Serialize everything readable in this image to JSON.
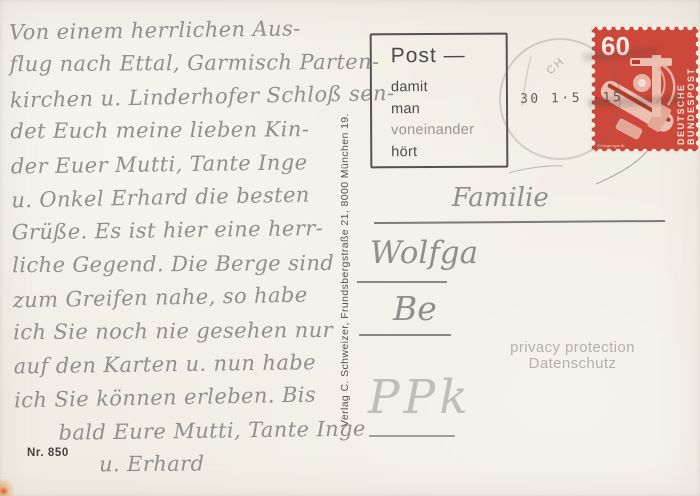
{
  "colors": {
    "paper": "#f1ede4",
    "stamp_red": "#cb483a",
    "pencil_gray": "#908f8b",
    "cancel_ink": "#4c4a46",
    "privacy_gray": "#b5b1a9"
  },
  "message": {
    "lines": [
      "Von einem herrlichen Aus-",
      "flug nach Ettal, Garmisch Parten-",
      "kirchen u. Linderhofer Schloß sen-",
      "det Euch meine lieben Kin-",
      "der Euer Mutti, Tante Inge",
      "u. Onkel Erhard die besten",
      "Grüße. Es ist hier eine herr-",
      "liche Gegend. Die Berge sind",
      "zum Greifen nahe, so habe",
      "ich Sie noch nie gesehen nur",
      "auf den Karten u. nun habe",
      "ich Sie können erleben. Bis",
      "bald Eure Mutti, Tante Inge",
      "u. Erhard"
    ]
  },
  "postcard": {
    "number": "Nr. 850",
    "publisher": "Verlag C. Schweizer, Frundsbergstraße 21, 8000 München 19.",
    "privacy_notice": {
      "line1": "privacy protection",
      "line2": "Datenschutz"
    }
  },
  "cancellation": {
    "slogan": {
      "heading": "Post —",
      "lines": [
        "damit",
        "man",
        "voneinander",
        "hört"
      ]
    },
    "city_fragment": "CH",
    "postmark_date": "30 1·5  -15"
  },
  "stamp": {
    "value": "60",
    "country": "DEUTSCHE BUNDESPOST",
    "caption": "Röntgengerät"
  },
  "address": {
    "line1": "Familie",
    "line2": "Wolfga",
    "line3": "Be",
    "scribble": "PPk"
  }
}
